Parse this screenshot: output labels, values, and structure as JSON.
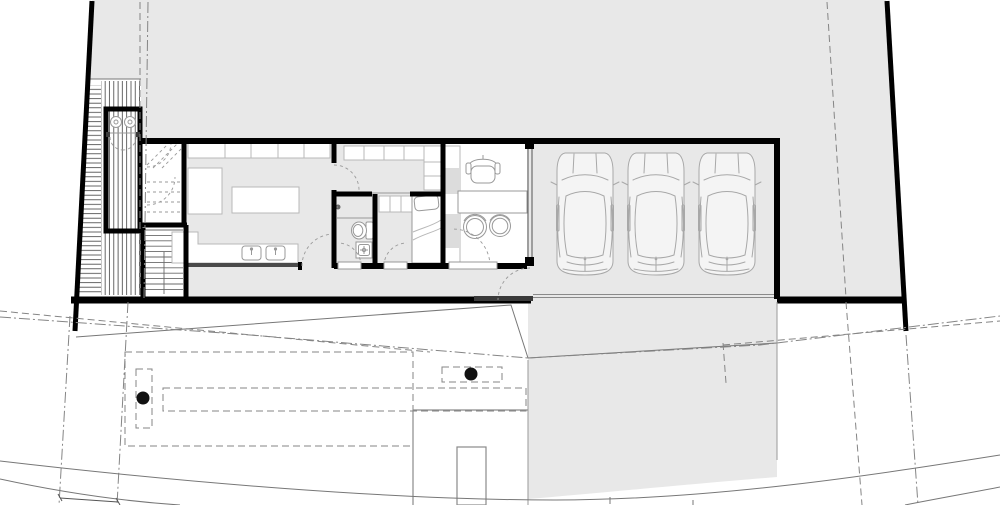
{
  "document": {
    "kind": "architectural floor plan / site plan drawing",
    "visible_text": "none"
  },
  "colors": {
    "paper": "#ffffff",
    "site_fill": "#e8e8e8",
    "wall": "#000000",
    "thin_line": "#777777",
    "medium_line": "#555555",
    "dashed_line": "#858585",
    "furniture_line": "#999999",
    "cabinet_line": "#b8b8b8",
    "car_line": "#a8a8a8",
    "car_fill": "#f4f4f4",
    "threshold_dark": "#3a3a3a",
    "tree_fill": "#111111",
    "hatch_stroke": "#3f3f3f",
    "road_line": "#777777"
  },
  "plan": {
    "site": {
      "shape": "trapezoidal lot, thick black boundary walls, left and right edges slanted",
      "surface": "light gray"
    },
    "areas": [
      "backyard",
      "timber-deck-hatched",
      "outdoor-wc",
      "entry-vestibule",
      "stairs",
      "kitchen",
      "pantry",
      "bathroom",
      "bedroom",
      "office",
      "garage",
      "south-walkway",
      "driveway-strip",
      "front-walkway"
    ],
    "fixtures": [
      "double-basin-pair",
      "kitchen-wall-cabinets",
      "kitchen-island",
      "kitchen-double-sink",
      "tall-unit",
      "pantry-cabinets",
      "shower-head",
      "shower-screen",
      "toilet",
      "washbasin",
      "closet-row",
      "single-bed",
      "shelving-column",
      "desk",
      "office-chair",
      "guest-chair",
      "guest-chair",
      "glazed-partition"
    ],
    "vehicles": {
      "count": 3,
      "type": "car, top view, parked facing north"
    },
    "trees": {
      "count": 2,
      "symbol": "solid black dot in dashed planter"
    },
    "door_swings": 9,
    "siteline_styles": [
      "dashed setback lines",
      "dash-dot easement lines",
      "curved road edges",
      "dimension tick line"
    ]
  }
}
